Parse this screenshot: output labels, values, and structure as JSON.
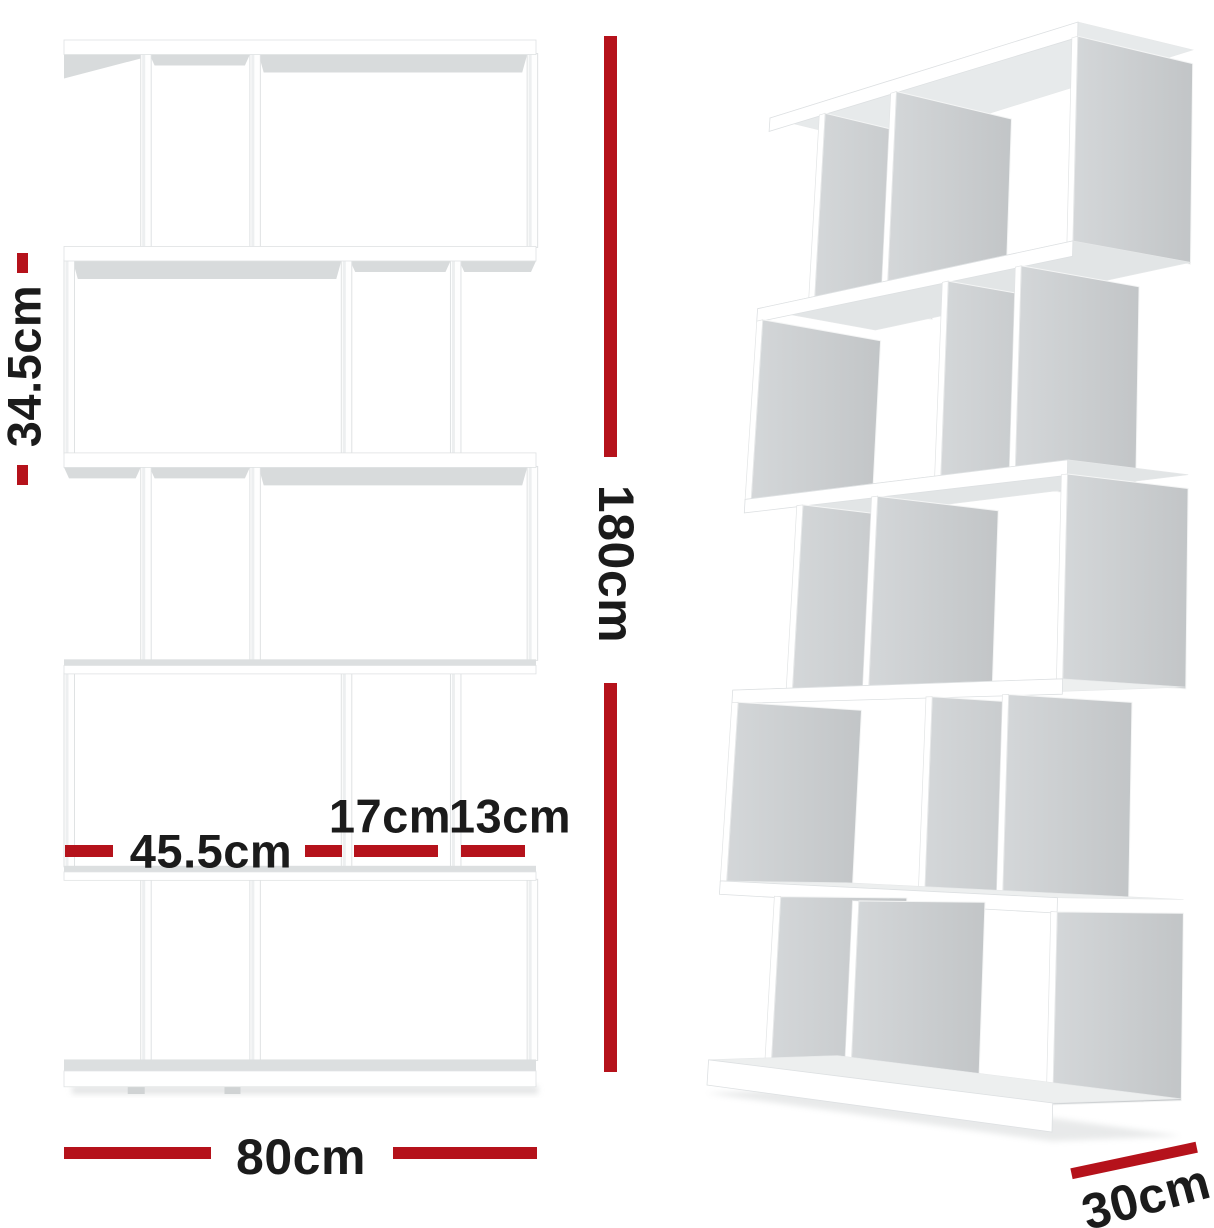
{
  "annotations": {
    "tier_height": "34.5cm",
    "total_height": "180cm",
    "large_compartment_width": "45.5cm",
    "medium_compartment_width": "17cm",
    "small_compartment_width": "13cm",
    "total_width": "80cm",
    "depth": "30cm"
  },
  "colors": {
    "dimension_red": "#b5121b",
    "label_text": "#1b1b1b",
    "panel_shade": "#c8cbcd",
    "board_white": "#ffffff"
  },
  "shelf": {
    "style": "S-shaped zigzag 5-tier display bookshelf, white",
    "tiers": 5,
    "width_cm": 80,
    "height_cm": 180,
    "depth_cm": 30,
    "tier_height_cm": 34.5,
    "compartment_widths_cm": [
      45.5,
      17,
      13
    ]
  }
}
